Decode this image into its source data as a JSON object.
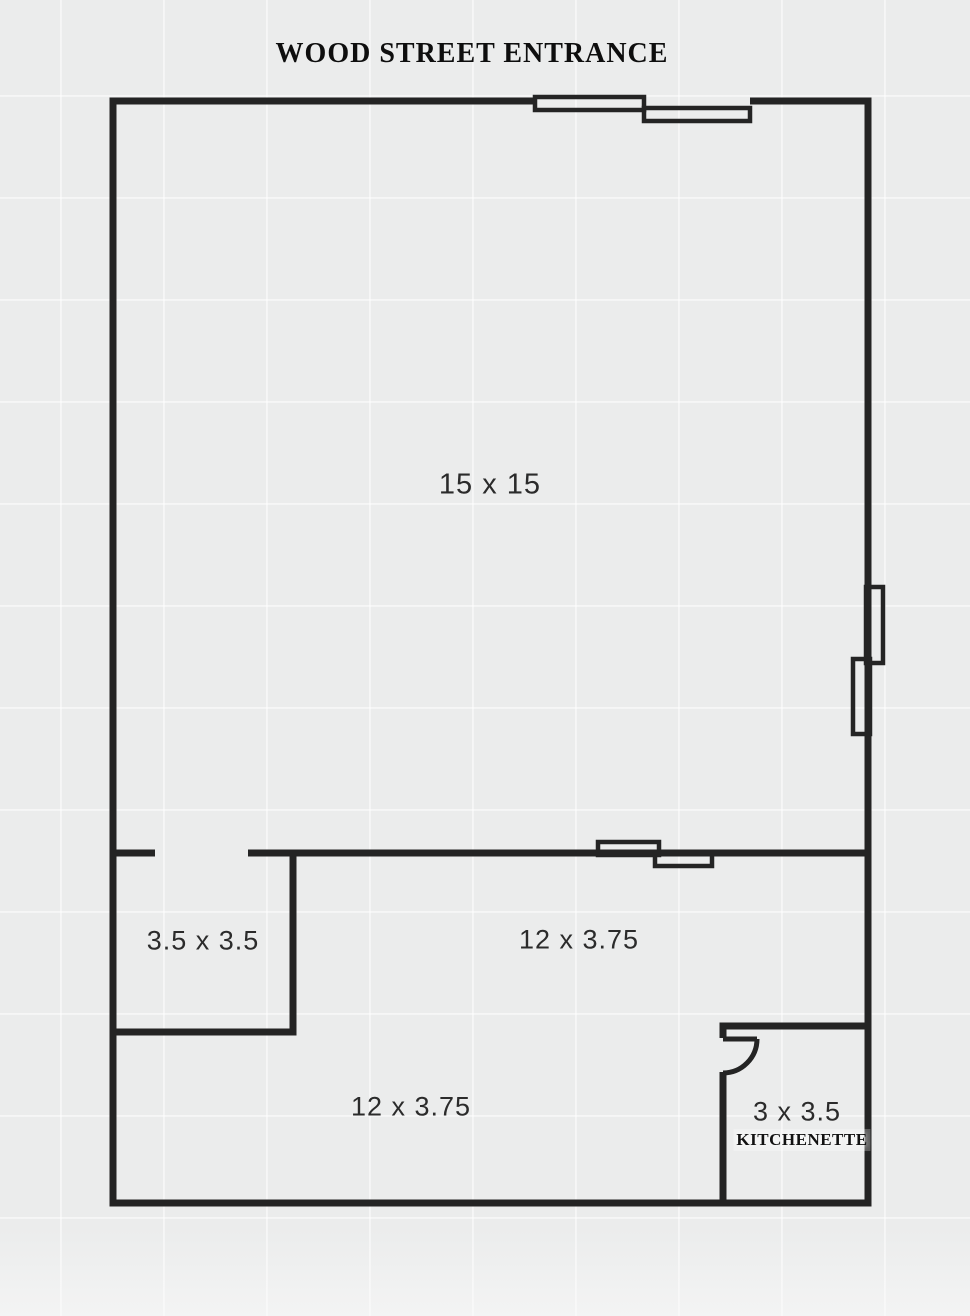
{
  "title": "WOOD STREET ENTRANCE",
  "colors": {
    "background": "#ebecec",
    "wall": "#242424",
    "label": "#2b2b2b",
    "title": "#0e0e0e"
  },
  "rooms": [
    {
      "id": "main-room",
      "dimensions": "15 x 15"
    },
    {
      "id": "side-room",
      "dimensions": "3.5 x 3.5"
    },
    {
      "id": "upper-corridor",
      "dimensions": "12 x 3.75"
    },
    {
      "id": "lower-corridor",
      "dimensions": "12 x 3.75"
    },
    {
      "id": "kitchenette",
      "dimensions": "3 x 3.5",
      "name": "KITCHENETTE"
    }
  ],
  "icons": {
    "sliding_door": "sliding-door-symbol",
    "swing_door": "swing-door-symbol"
  }
}
